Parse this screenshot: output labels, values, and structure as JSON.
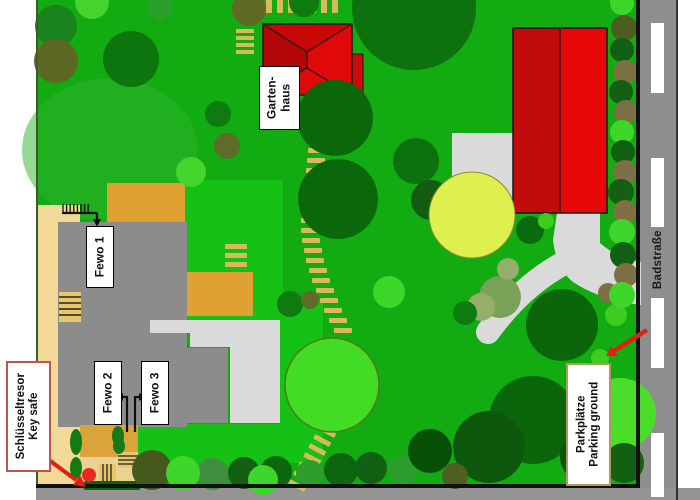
{
  "labels": {
    "gartenhaus": {
      "line1": "Garten-",
      "line2": "haus"
    },
    "fewo1": "Fewo 1",
    "fewo2": "Fewo 2",
    "fewo3": "Fewo 3",
    "keysafe": {
      "line1": "Schlüsseltresor",
      "line2": "Key safe"
    },
    "parking": {
      "line1": "Parkplätze",
      "line2": "Parking ground"
    },
    "street": "Badstraße"
  },
  "colors": {
    "lawn": "#12ab12",
    "bright_lawn": "#15c115",
    "road": "#8e8e8e",
    "house_gray": "#8c8c8c",
    "patio_gray": "#dadada",
    "building_red": "#e60808",
    "building_red_dark": "#c20c0c",
    "gartenhaus_red": "#e00808",
    "path_tan": "#f2d998",
    "step_tan": "#d9b85e",
    "terrace_orange": "#dfa232",
    "keysafe_red": "#e8281c",
    "arrow_red": "#e02015"
  }
}
